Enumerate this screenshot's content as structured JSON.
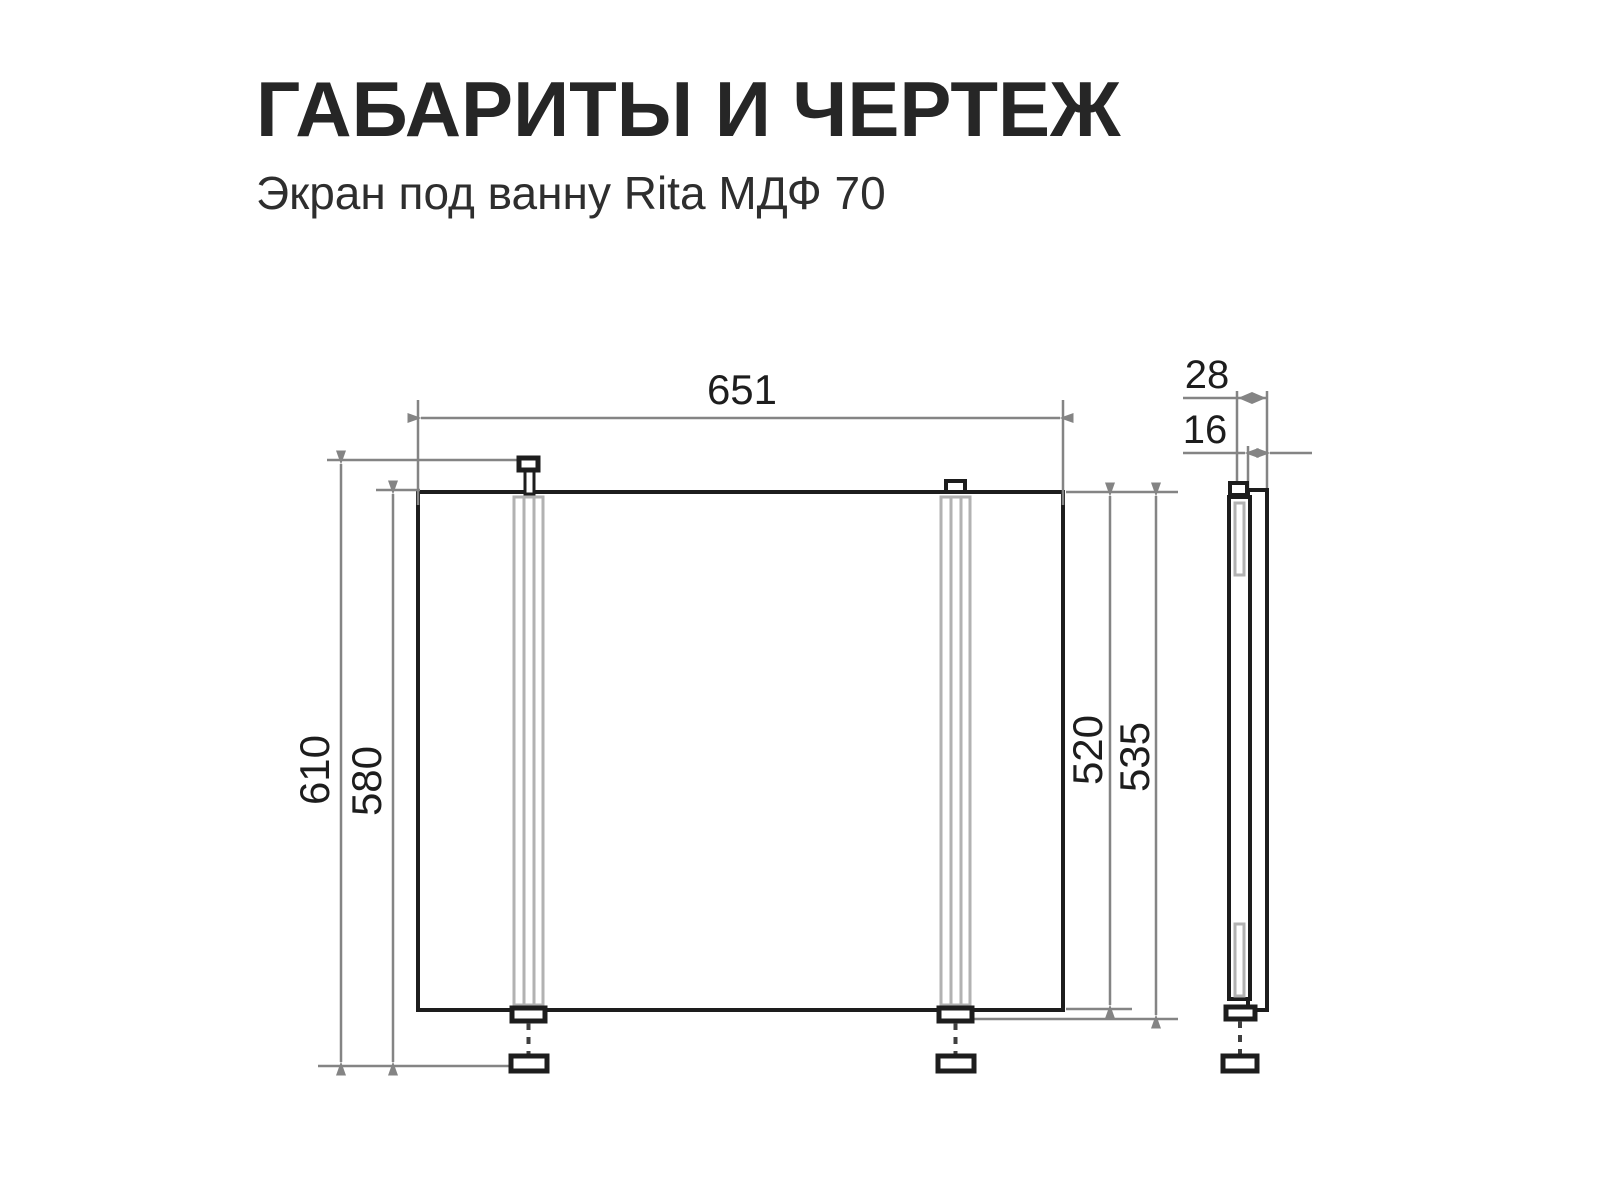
{
  "title": "ГАБАРИТЫ И ЧЕРТЕЖ",
  "subtitle": "Экран под ванну Rita МДФ 70",
  "dimensions": {
    "width": "651",
    "overall_height": "610",
    "screen_height": "580",
    "panel_height": "520",
    "height_with_bracket": "535",
    "depth_total": "28",
    "panel_thickness": "16"
  },
  "colors": {
    "ink": "#1d1d1d",
    "dimension_gray": "#848484",
    "hidden_part_gray": "#b2b2b2",
    "background": "#ffffff"
  }
}
